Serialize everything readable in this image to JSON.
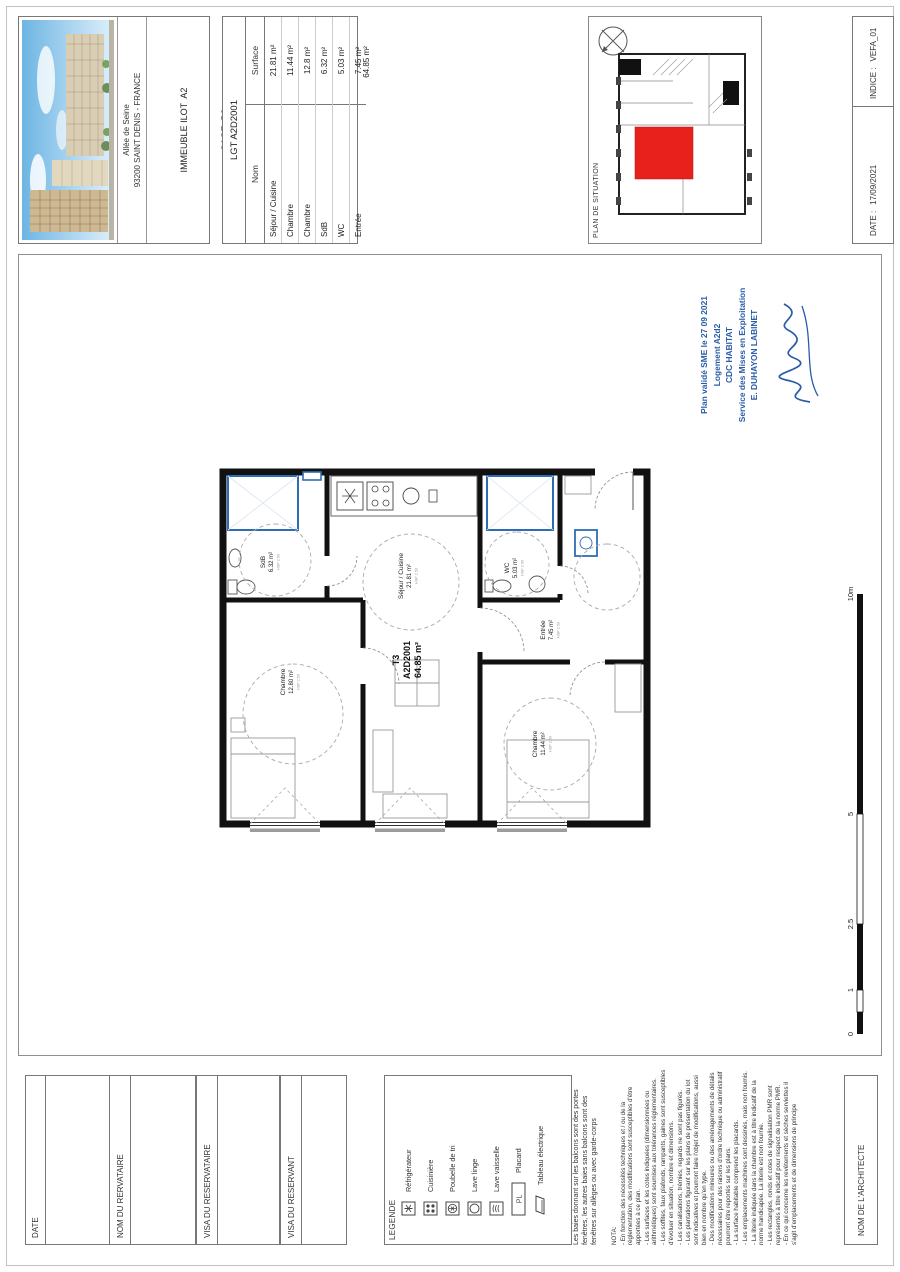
{
  "title_block": {
    "address_line1": "Allée de Seine",
    "address_line2": "93200 SAINT DENIS - FRANCE",
    "building_line1": "IMMEUBLE ILOT  A2",
    "building_line2": "CAGE  D2",
    "logo_text": "VINCI",
    "logo_subtext": "IMMOBILIER"
  },
  "surface_table": {
    "lot_title": "LGT A2D2001",
    "col_name": "Nom",
    "col_surface": "Surface",
    "rows": [
      {
        "name": "Séjour / Cuisine",
        "surface": "21.81 m²"
      },
      {
        "name": "Chambre",
        "surface": "11.44 m²"
      },
      {
        "name": "Chambre",
        "surface": "12.8 m²"
      },
      {
        "name": "SdB",
        "surface": "6.32 m²"
      },
      {
        "name": "WC",
        "surface": "5.03 m²"
      },
      {
        "name": "Entrée",
        "surface": "7.45 m²"
      }
    ],
    "total": "64.85 m²"
  },
  "situation": {
    "label": "PLAN DE SITUATION"
  },
  "meta": {
    "date_label": "DATE :",
    "date_value": "17/09/2021",
    "indice_label": "INDICE :",
    "indice_value": "VEFA_01"
  },
  "plan": {
    "unit_type": "T3",
    "unit_code": "A2D2001",
    "unit_area": "64.85 m²",
    "rooms": [
      {
        "name": "Chambre",
        "area": "12.80 m²",
        "details": "HSP 2.50"
      },
      {
        "name": "SdB",
        "area": "6.32 m²",
        "details": "HSP 2.50"
      },
      {
        "name": "Séjour / Cuisine",
        "area": "21.81 m²",
        "details": "HSP 2.50"
      },
      {
        "name": "WC",
        "area": "5.03 m²",
        "details": "HSP 2.50"
      },
      {
        "name": "Entrée",
        "area": "7.45 m²",
        "details": "HSP 2.50"
      },
      {
        "name": "Chambre",
        "area": "11.44 m²",
        "details": "HSP 2.50"
      }
    ],
    "scale_labels": [
      "0",
      "1",
      "2.5",
      "5",
      "10m"
    ]
  },
  "stamp": {
    "line1": "Plan validé SME le 27 09 2021",
    "line2": "Logement A2d2",
    "line3": "CDC HABITAT",
    "line4": "Service des Mises en Exploitation",
    "line5": "E. DUHAYON LABINET"
  },
  "signature_blocks": {
    "date": "DATE",
    "nom_reservataire": "NOM DU RERVATAIRE",
    "visa_reservataire": "VISA DU RESERVATAIRE",
    "visa_reservant": "VISA DU RESERVANT",
    "architecte": "NOM DE L'ARCHITECTE"
  },
  "legend": {
    "title": "LEGENDE",
    "items": [
      {
        "label": "Réfrigérateur"
      },
      {
        "label": "Cuisinière"
      },
      {
        "label": "Poubelle de tri"
      },
      {
        "label": "Lave linge"
      },
      {
        "label": "Lave vaisselle"
      },
      {
        "label": "Placard",
        "icon_text": "PL"
      },
      {
        "label": "Tableau électrique"
      }
    ],
    "note": "Les baies donnant sur les balcons sont des portes fenêtres, les autres baies sans balcons sont des fenêtres sur allèges ou avec garde-corps"
  },
  "nota": {
    "title": "NOTA:",
    "lines": [
      "- En fonction des nécessités techniques et / ou de la réglementation, des modifications sont susceptibles d'être apportées à ce plan.",
      "- Les surfaces et les cotes indiquées (dimensionnées ou arithmétiques) sont soumises aux tolérances réglementaires.",
      "- Les soffites, faux plafonds, rampants, gaines sont susceptibles d'évoluer en situation, nombre et dimensions.",
      "- Les canalisations, trémies, regards ne sont pas figurés.",
      "- Les plantations figurant sur les plans de présentation du lot sont indicatives et pourront faire l'objet de modifications, aussi bien en nombre qu'en type.",
      "- Des modifications mineures ou des aménagements de détails nécessaires pour des raisons d'ordre technique ou administratif pourront être reportés sur les plans.",
      "- La surface habitable comprend les placards.",
      "- Les emplacements machines sont dessinés, mais non fournis.",
      "- La literie indiquée dans la chambre est à titre indicatif de la norme handicapée. La literie est non fournie.",
      "- Les rectangles, ronds et cotes de signalisation PMR sont représentés à titre indicatif pour respect de la norme PMR.",
      "- En ce qui concerne les revêtements et sèches serviettes il s'agit d'emplacements et de dimensions de principe"
    ]
  },
  "colors": {
    "highlight_red": "#e8211d",
    "stamp_blue": "#2a5caa",
    "fixture_blue": "#2e6db4",
    "vinci_blue": "#16328c",
    "vinci_red": "#e4032e"
  }
}
